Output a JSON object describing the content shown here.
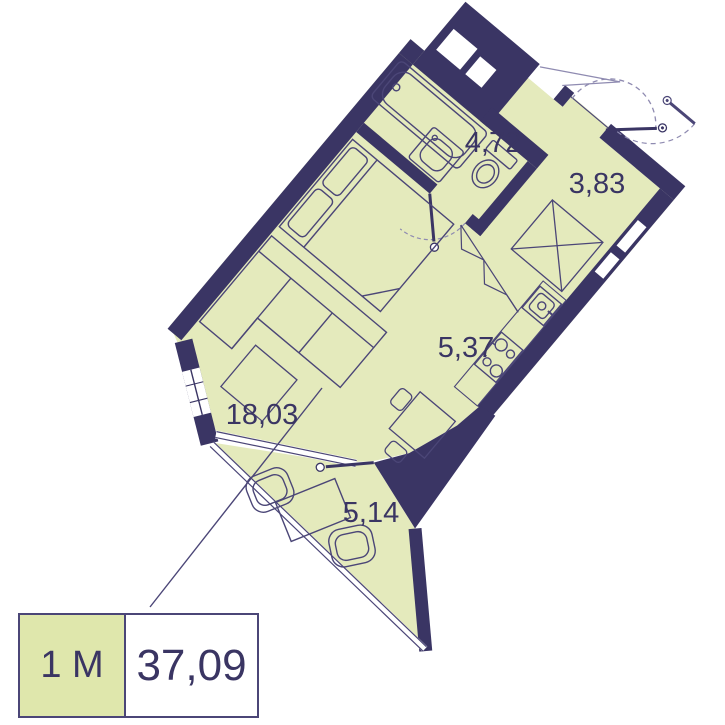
{
  "plan": {
    "title": "studio apartment floor plan",
    "rooms": [
      {
        "key": "bathroom",
        "area": "4,72"
      },
      {
        "key": "hallway",
        "area": "3,83"
      },
      {
        "key": "kitchen",
        "area": "5,37"
      },
      {
        "key": "living_room",
        "area": "18,03"
      },
      {
        "key": "balcony",
        "area": "5,14"
      }
    ]
  },
  "legend": {
    "unit_type": "1 М",
    "total_area": "37,09"
  },
  "colors": {
    "wall": "#3a3564",
    "floor": "#e4eabc",
    "legend_fill": "#dfe7ac",
    "outline": "#4b4677",
    "light_line": "#8f8bb1",
    "text": "#3a3563"
  }
}
